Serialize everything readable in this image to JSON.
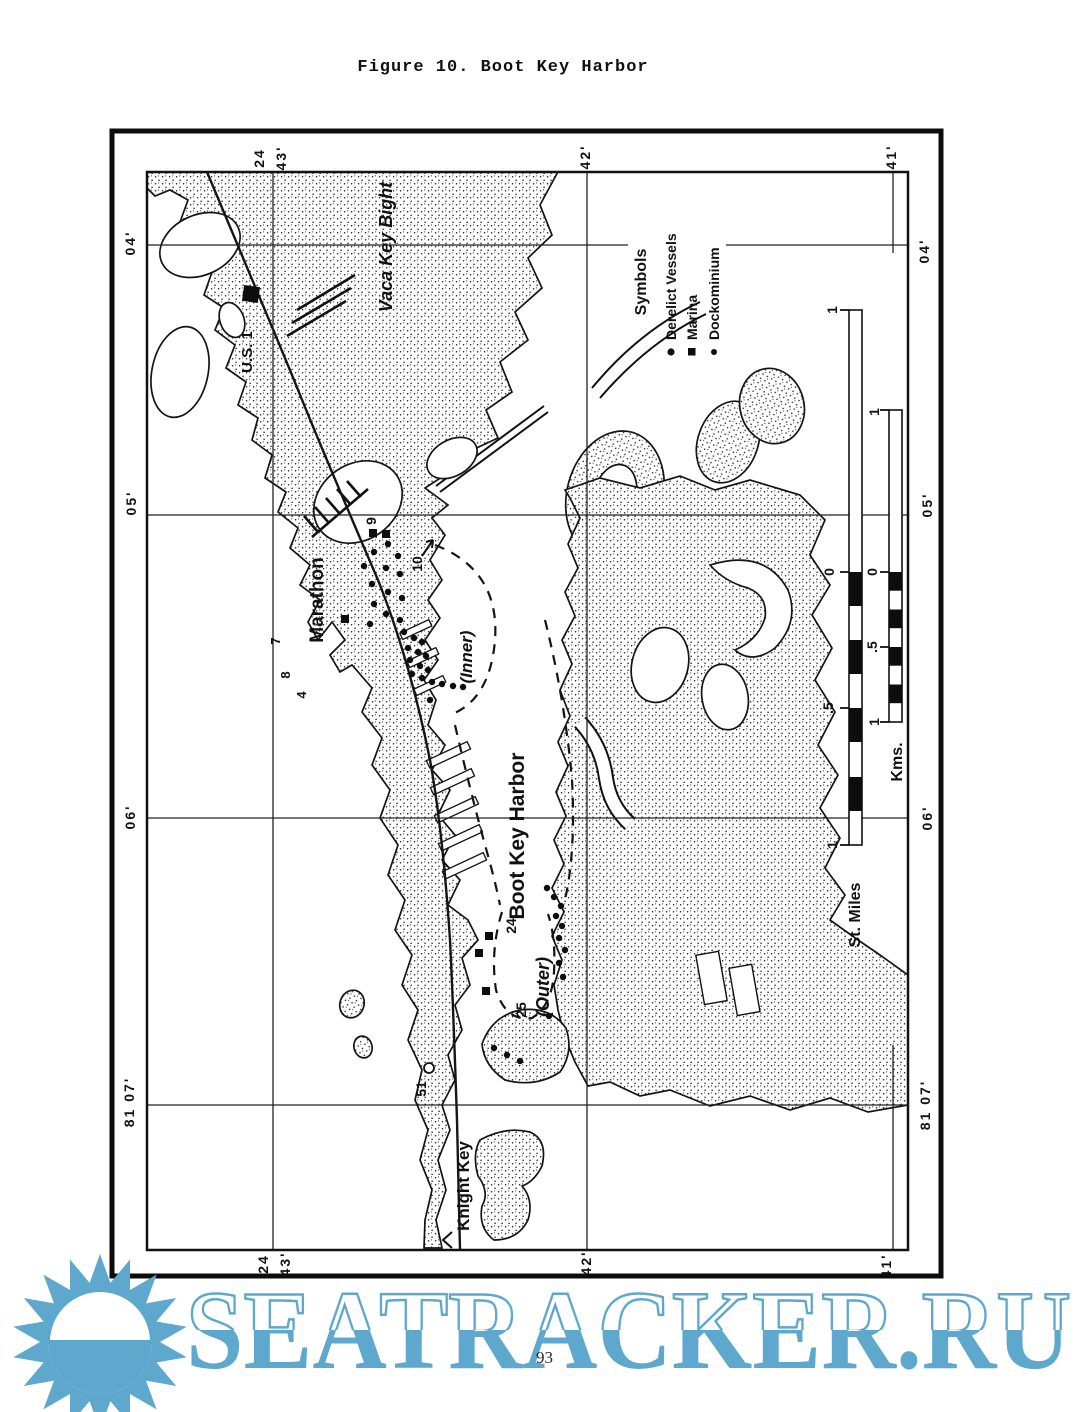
{
  "page": {
    "title": "Figure 10.  Boot Key Harbor",
    "number": "93"
  },
  "map": {
    "coordinates": {
      "top": [
        "24",
        "43'",
        "42'",
        "41'"
      ],
      "bottom": [
        "24",
        "43'",
        "42'",
        "41'"
      ],
      "left": [
        "04'",
        "05'",
        "06'",
        "81 07'"
      ],
      "right": [
        "04'",
        "05'",
        "06'",
        "81 07'"
      ]
    },
    "places": {
      "vaca_key_bight": "Vaca Key Bight",
      "us_1": "U.S. 1",
      "marathon": "Marathon",
      "boot_key_harbor": "Boot Key Harbor",
      "inner": "(Inner)",
      "outer": "(Outer)",
      "knight_key": "Knight Key"
    },
    "sites": [
      "9",
      "10",
      "7",
      "8",
      "4",
      "24",
      "25",
      "51"
    ],
    "legend": {
      "header": "Symbols",
      "items": [
        {
          "symbol": "dot",
          "label": "Derelict Vessels"
        },
        {
          "symbol": "square",
          "label": "Marina"
        },
        {
          "symbol": "small-dot",
          "label": "Dockominium"
        }
      ]
    },
    "scales": {
      "miles": {
        "label": "St. Miles",
        "ticks": [
          "1",
          "0",
          ".5",
          "1"
        ]
      },
      "kms": {
        "label": "Kms.",
        "ticks": [
          "1",
          "0",
          ".5",
          "1"
        ]
      }
    }
  },
  "watermark": {
    "text": "SEATRACKER.RU",
    "color": "#5fa8cd"
  }
}
